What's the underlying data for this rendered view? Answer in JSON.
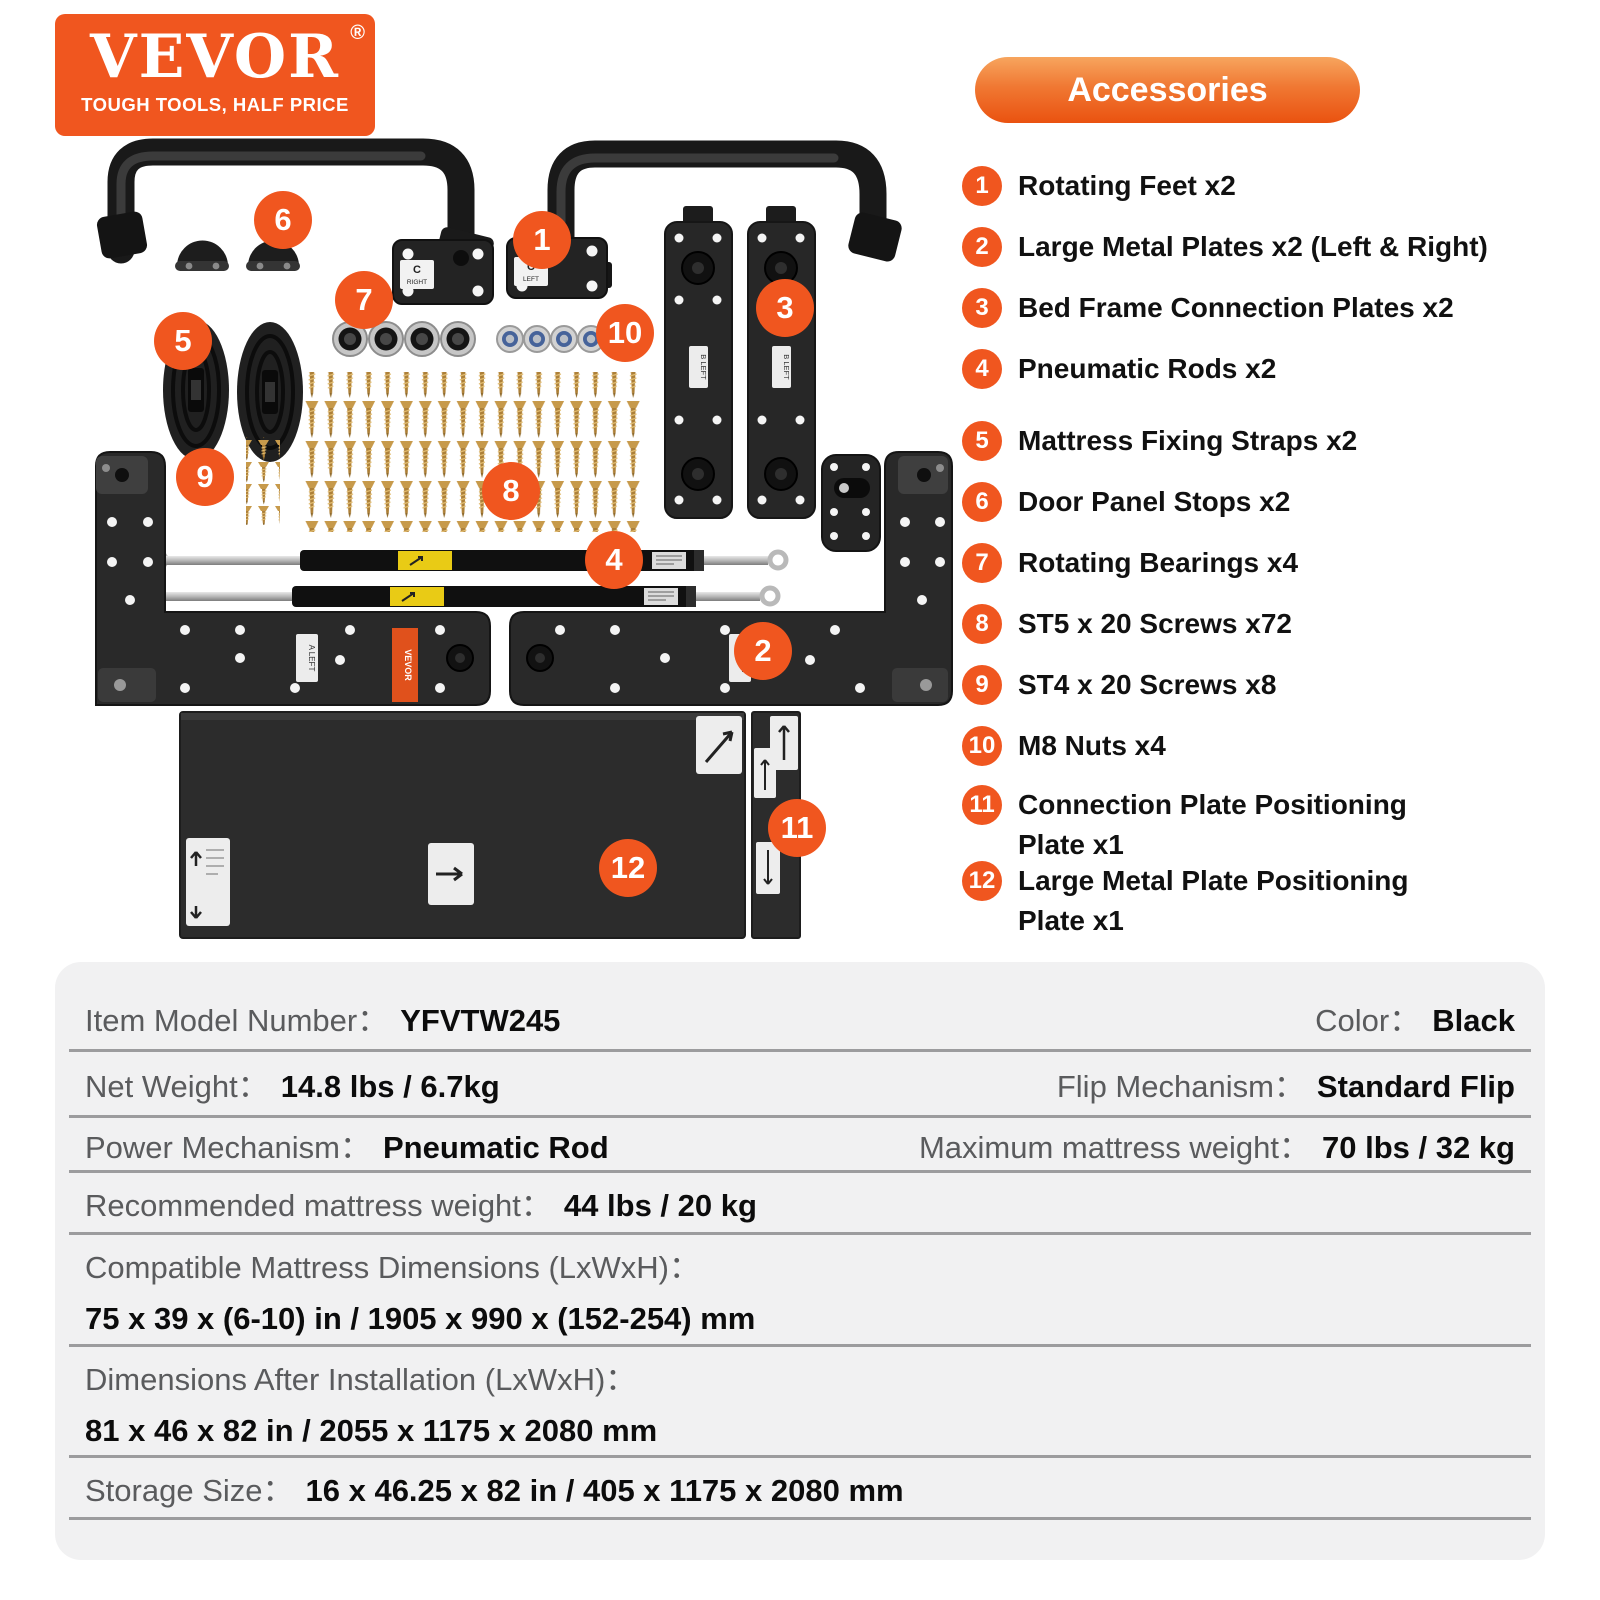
{
  "brand": {
    "name": "VEVOR",
    "registered": "®",
    "tagline": "TOUGH TOOLS, HALF PRICE"
  },
  "accessories": {
    "title": "Accessories",
    "items": [
      {
        "num": "1",
        "label": "Rotating Feet x2"
      },
      {
        "num": "2",
        "label": "Large Metal Plates x2 (Left & Right)"
      },
      {
        "num": "3",
        "label": "Bed Frame Connection Plates x2"
      },
      {
        "num": "4",
        "label": "Pneumatic Rods x2"
      },
      {
        "num": "5",
        "label": "Mattress Fixing Straps x2"
      },
      {
        "num": "6",
        "label": "Door Panel Stops x2"
      },
      {
        "num": "7",
        "label": "Rotating Bearings x4"
      },
      {
        "num": "8",
        "label": "ST5 x 20 Screws x72"
      },
      {
        "num": "9",
        "label": "ST4 x 20 Screws x8"
      },
      {
        "num": "10",
        "label": "M8 Nuts x4"
      },
      {
        "num": "11",
        "label": "Connection Plate Positioning\nPlate x1"
      },
      {
        "num": "12",
        "label": "Large Metal Plate Positioning\nPlate x1"
      }
    ]
  },
  "markers": [
    "1",
    "2",
    "3",
    "4",
    "5",
    "6",
    "7",
    "8",
    "9",
    "10",
    "11",
    "12"
  ],
  "collage": {
    "labels": {
      "c_letter": "C",
      "c_right": "RIGHT",
      "c_left": "LEFT",
      "b_left": "B LEFT",
      "a_left": "A LEFT",
      "a_right": "A RIGHT",
      "sticker": "VEVOR"
    }
  },
  "specs": {
    "rows": [
      {
        "left_label": "Item Model Number：",
        "left_value": "YFVTW245",
        "right_label": "Color：",
        "right_value": "Black"
      },
      {
        "left_label": "Net Weight：",
        "left_value": "14.8 lbs / 6.7kg",
        "right_label": "Flip Mechanism：",
        "right_value": "Standard Flip"
      },
      {
        "left_label": "Power Mechanism：",
        "left_value": "Pneumatic Rod",
        "right_label": "Maximum mattress weight：",
        "right_value": "70 lbs / 32 kg"
      },
      {
        "left_label": "Recommended mattress weight：",
        "left_value": "44 lbs / 20 kg"
      },
      {
        "left_label": "Compatible Mattress Dimensions (LxWxH)：",
        "left_value": "75 x 39 x (6-10) in / 1905 x 990 x (152-254) mm"
      },
      {
        "left_label": "Dimensions After Installation (LxWxH)：",
        "left_value": "81 x 46 x 82 in / 2055 x 1175 x 2080 mm"
      },
      {
        "left_label": "Storage Size：",
        "left_value": "16 x 46.25 x 82 in / 405 x 1175 x 2080 mm"
      }
    ]
  },
  "colors": {
    "brand_orange": "#f0561f",
    "pill_gradient_top": "#f7a55e",
    "pill_gradient_bottom": "#ea5210",
    "table_bg": "#f1f1f2",
    "separator": "#9c9c9e",
    "label_gray": "#5a5b5d",
    "value_black": "#0c0c0c"
  }
}
